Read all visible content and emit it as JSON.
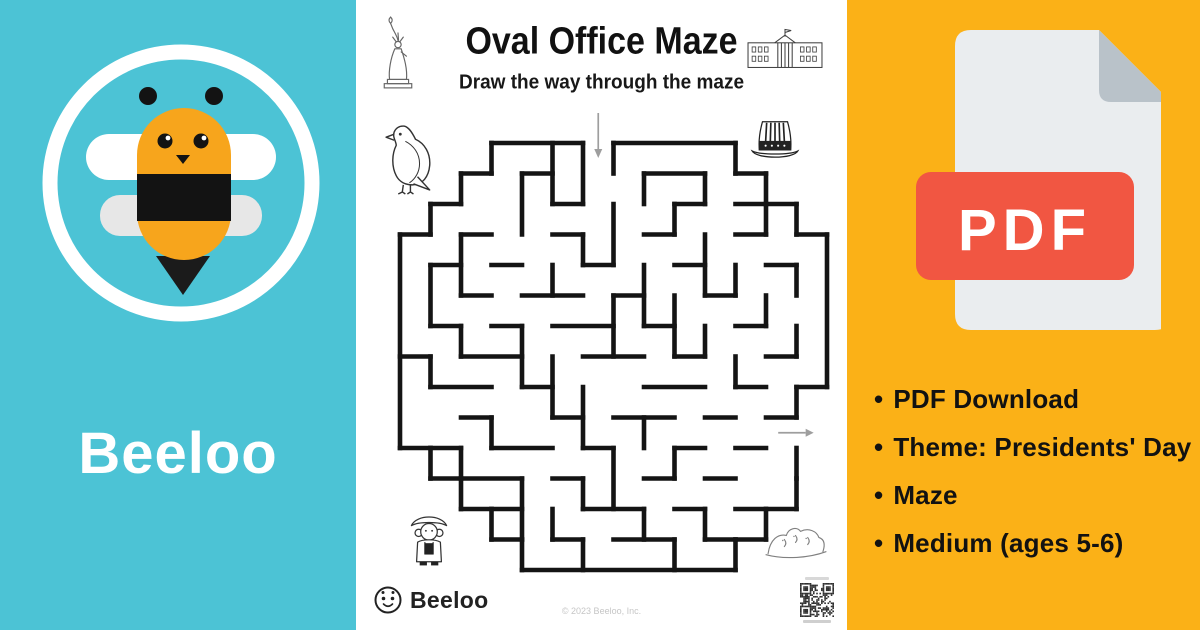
{
  "brand": {
    "name": "Beeloo"
  },
  "colors": {
    "teal": "#4CC3D5",
    "orange": "#FBB117",
    "pdf_red": "#F15642",
    "doc_gray": "#EAEDEF",
    "fold_gray": "#B9C2C9",
    "bee_yellow": "#F7A51C",
    "maze_wall": "#141414",
    "maze_arrow": "#9E9E9E"
  },
  "left_panel": {
    "wordmark": "Beeloo"
  },
  "worksheet": {
    "title": "Oval Office Maze",
    "subtitle": "Draw the way through the maze",
    "footer_brand": "Beeloo",
    "copyright": "© 2023 Beeloo, Inc.",
    "decorations": [
      "statue-of-liberty",
      "white-house",
      "bald-eagle",
      "uncle-sam-hat",
      "george-washington",
      "mount-rushmore"
    ],
    "maze": {
      "cols": 14,
      "rows": 14,
      "cell": 30.5,
      "entry": {
        "x": 6.5
      },
      "exit": {
        "y": 9.5
      },
      "boundary": [
        [
          3,
          0,
          6,
          0
        ],
        [
          7,
          0,
          11,
          0
        ],
        [
          11,
          0,
          11,
          1
        ],
        [
          11,
          1,
          12,
          1
        ],
        [
          12,
          1,
          12,
          2
        ],
        [
          12,
          2,
          13,
          2
        ],
        [
          13,
          2,
          13,
          3
        ],
        [
          13,
          3,
          14,
          3
        ],
        [
          14,
          3,
          14,
          8
        ],
        [
          13,
          8,
          14,
          8
        ],
        [
          13,
          8,
          13,
          9
        ],
        [
          13,
          10,
          13,
          11
        ],
        [
          13,
          11,
          13,
          12
        ],
        [
          12,
          12,
          13,
          12
        ],
        [
          12,
          12,
          12,
          13
        ],
        [
          11,
          13,
          12,
          13
        ],
        [
          11,
          13,
          11,
          14
        ],
        [
          4,
          14,
          11,
          14
        ],
        [
          4,
          13,
          4,
          14
        ],
        [
          3,
          13,
          4,
          13
        ],
        [
          3,
          12,
          3,
          13
        ],
        [
          2,
          12,
          3,
          12
        ],
        [
          2,
          11,
          2,
          12
        ],
        [
          1,
          11,
          2,
          11
        ],
        [
          1,
          10,
          1,
          11
        ],
        [
          0,
          10,
          1,
          10
        ],
        [
          0,
          3,
          0,
          10
        ],
        [
          0,
          3,
          1,
          3
        ],
        [
          1,
          2,
          1,
          3
        ],
        [
          1,
          2,
          2,
          2
        ],
        [
          2,
          1,
          2,
          2
        ],
        [
          2,
          1,
          3,
          1
        ],
        [
          3,
          0,
          3,
          1
        ]
      ],
      "walls": [
        [
          4,
          1,
          5,
          1
        ],
        [
          8,
          1,
          10,
          1
        ],
        [
          5,
          2,
          6,
          2
        ],
        [
          9,
          2,
          10,
          2
        ],
        [
          11,
          2,
          12,
          2
        ],
        [
          2,
          3,
          3,
          3
        ],
        [
          5,
          3,
          6,
          3
        ],
        [
          8,
          3,
          9,
          3
        ],
        [
          11,
          3,
          12,
          3
        ],
        [
          1,
          4,
          2,
          4
        ],
        [
          3,
          4,
          4,
          4
        ],
        [
          6,
          4,
          7,
          4
        ],
        [
          9,
          4,
          10,
          4
        ],
        [
          12,
          4,
          13,
          4
        ],
        [
          2,
          5,
          3,
          5
        ],
        [
          4,
          5,
          6,
          5
        ],
        [
          7,
          5,
          8,
          5
        ],
        [
          10,
          5,
          11,
          5
        ],
        [
          1,
          6,
          2,
          6
        ],
        [
          3,
          6,
          4,
          6
        ],
        [
          5,
          6,
          7,
          6
        ],
        [
          8,
          6,
          9,
          6
        ],
        [
          11,
          6,
          12,
          6
        ],
        [
          0,
          7,
          1,
          7
        ],
        [
          2,
          7,
          4,
          7
        ],
        [
          6,
          7,
          8,
          7
        ],
        [
          9,
          7,
          10,
          7
        ],
        [
          12,
          7,
          13,
          7
        ],
        [
          1,
          8,
          3,
          8
        ],
        [
          4,
          8,
          5,
          8
        ],
        [
          8,
          8,
          10,
          8
        ],
        [
          11,
          8,
          12,
          8
        ],
        [
          2,
          9,
          3,
          9
        ],
        [
          5,
          9,
          6,
          9
        ],
        [
          7,
          9,
          9,
          9
        ],
        [
          10,
          9,
          11,
          9
        ],
        [
          12,
          9,
          13,
          9
        ],
        [
          1,
          10,
          2,
          10
        ],
        [
          3,
          10,
          5,
          10
        ],
        [
          6,
          10,
          7,
          10
        ],
        [
          9,
          10,
          10,
          10
        ],
        [
          11,
          10,
          12,
          10
        ],
        [
          2,
          11,
          4,
          11
        ],
        [
          5,
          11,
          6,
          11
        ],
        [
          8,
          11,
          9,
          11
        ],
        [
          10,
          11,
          11,
          11
        ],
        [
          3,
          12,
          4,
          12
        ],
        [
          6,
          12,
          8,
          12
        ],
        [
          9,
          12,
          10,
          12
        ],
        [
          11,
          12,
          12,
          12
        ],
        [
          5,
          13,
          6,
          13
        ],
        [
          7,
          13,
          9,
          13
        ],
        [
          10,
          13,
          11,
          13
        ],
        [
          5,
          0,
          5,
          2
        ],
        [
          6,
          0,
          6,
          2
        ],
        [
          7,
          0,
          7,
          1
        ],
        [
          4,
          1,
          4,
          3
        ],
        [
          8,
          1,
          8,
          2
        ],
        [
          10,
          1,
          10,
          2
        ],
        [
          2,
          3,
          2,
          5
        ],
        [
          7,
          2,
          7,
          4
        ],
        [
          9,
          2,
          9,
          3
        ],
        [
          12,
          2,
          12,
          3
        ],
        [
          1,
          4,
          1,
          6
        ],
        [
          5,
          4,
          5,
          5
        ],
        [
          6,
          3,
          6,
          4
        ],
        [
          8,
          4,
          8,
          6
        ],
        [
          10,
          3,
          10,
          5
        ],
        [
          11,
          4,
          11,
          5
        ],
        [
          13,
          4,
          13,
          5
        ],
        [
          2,
          6,
          2,
          7
        ],
        [
          4,
          6,
          4,
          8
        ],
        [
          7,
          5,
          7,
          7
        ],
        [
          9,
          5,
          9,
          7
        ],
        [
          12,
          5,
          12,
          6
        ],
        [
          13,
          6,
          13,
          7
        ],
        [
          1,
          7,
          1,
          8
        ],
        [
          5,
          7,
          5,
          9
        ],
        [
          6,
          8,
          6,
          10
        ],
        [
          10,
          6,
          10,
          7
        ],
        [
          11,
          7,
          11,
          8
        ],
        [
          3,
          9,
          3,
          10
        ],
        [
          8,
          9,
          8,
          10
        ],
        [
          9,
          10,
          9,
          11
        ],
        [
          2,
          10,
          2,
          11
        ],
        [
          4,
          11,
          4,
          13
        ],
        [
          6,
          11,
          6,
          12
        ],
        [
          7,
          10,
          7,
          12
        ],
        [
          5,
          12,
          5,
          13
        ],
        [
          8,
          12,
          8,
          13
        ],
        [
          10,
          12,
          10,
          13
        ],
        [
          6,
          13,
          6,
          14
        ],
        [
          9,
          13,
          9,
          14
        ]
      ]
    }
  },
  "right_panel": {
    "pdf_label": "PDF",
    "bullet_char": "•",
    "bullets": [
      "PDF Download",
      "Theme: Presidents' Day",
      "Maze",
      "Medium (ages 5-6)"
    ]
  }
}
